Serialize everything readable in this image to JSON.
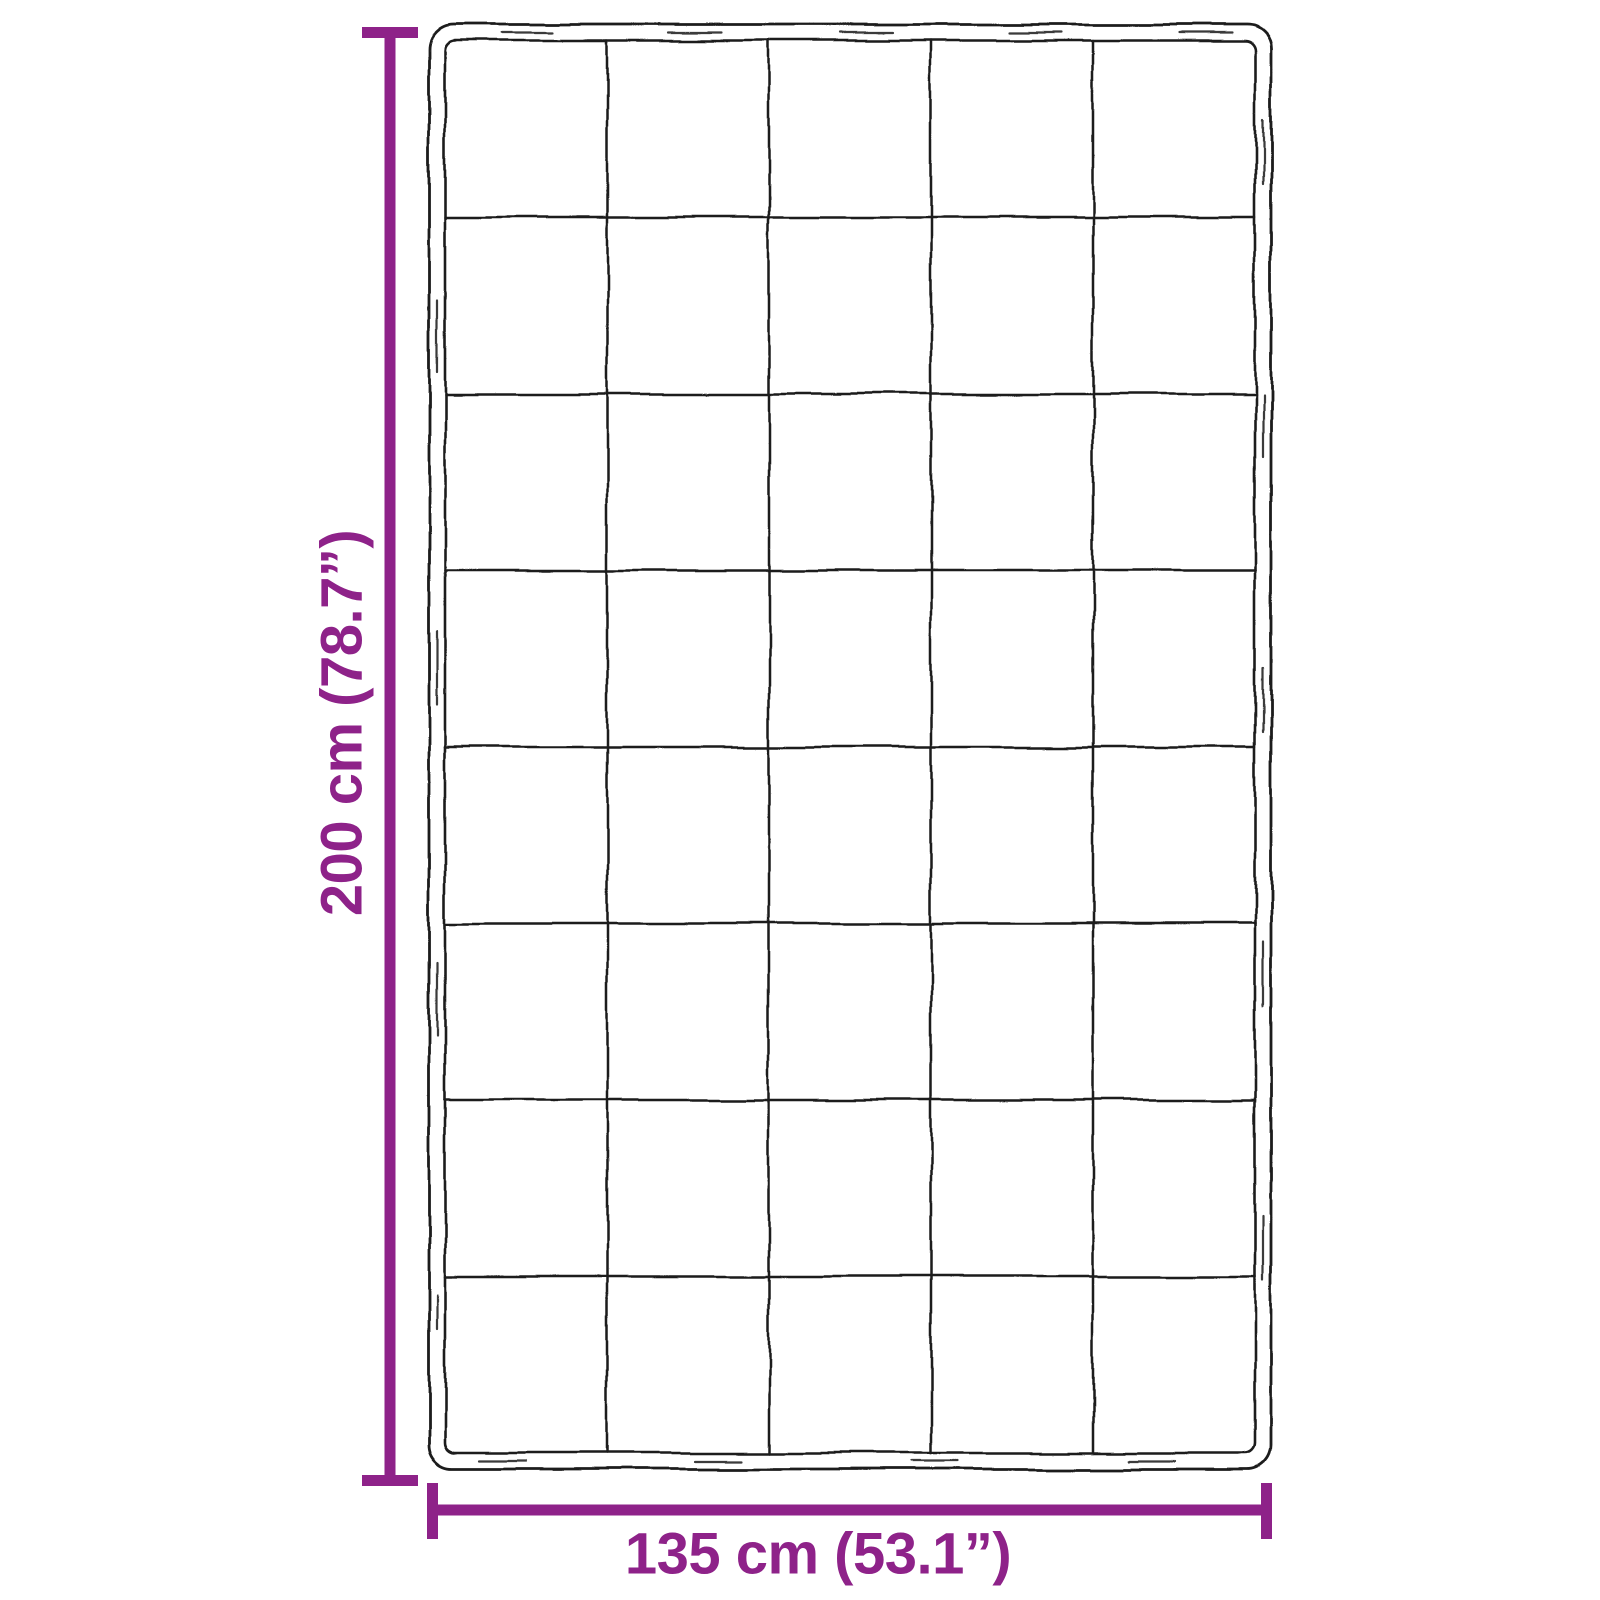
{
  "diagram": {
    "kind": "product-dimension-diagram",
    "subject": "weighted-blanket-top-view-sketch",
    "colors": {
      "dimension_accent": "#8E2289",
      "sketch_line": "#1c1c1c",
      "background": "#ffffff"
    },
    "dimensions": {
      "height": {
        "label": "200 cm (78.7”)",
        "value_cm": "200",
        "value_inches": "78.7"
      },
      "width": {
        "label": "135 cm (53.1”)",
        "value_cm": "135",
        "value_inches": "53.1"
      }
    },
    "grid": {
      "columns": 5,
      "rows": 8
    }
  }
}
